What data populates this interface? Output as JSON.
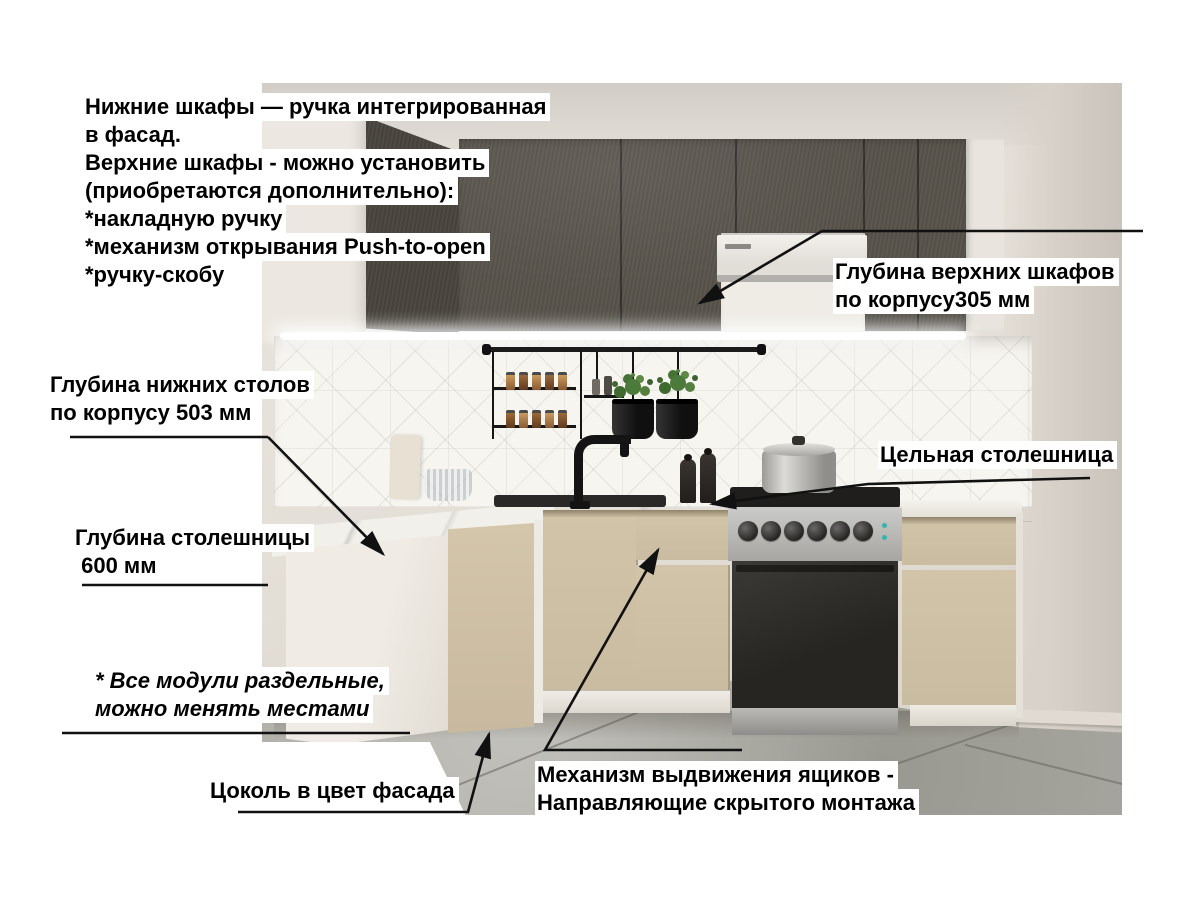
{
  "annotations": {
    "handles_note": {
      "lines": [
        "Нижние шкафы — ручка интегрированная",
        "в фасад.",
        "Верхние шкафы - можно установить",
        "(приобретаются дополнительно):",
        "*накладную ручку",
        "*механизм открывания Push-to-open",
        "*ручку-скобу"
      ]
    },
    "upper_cabinet_depth": {
      "lines": [
        "Глубина верхних шкафов",
        "по корпусу305 мм"
      ]
    },
    "base_cabinet_depth": {
      "lines": [
        "Глубина нижних столов",
        "по корпусу 503 мм"
      ]
    },
    "solid_countertop": {
      "label": "Цельная столешница"
    },
    "countertop_depth": {
      "lines": [
        "Глубина столешницы",
        " 600 мм"
      ]
    },
    "modules_note": {
      "lines": [
        "* Все модули раздельные,",
        "можно менять местами"
      ]
    },
    "plinth_note": {
      "label": "Цоколь в цвет фасада"
    },
    "drawer_note": {
      "lines": [
        "Механизм выдвижения ящиков -",
        "Направляющие скрытого монтажа"
      ]
    }
  },
  "colors": {
    "upper_facade": "#57534b",
    "lower_facade": "#cfc1a5",
    "countertop": "#f2f0ea",
    "backsplash": "#f7f5f0",
    "floor_tile": "#abaaa2",
    "wall": "#d9d3cc",
    "annotation_text": "#000000",
    "annotation_line": "#111111",
    "label_background": "#ffffff"
  }
}
